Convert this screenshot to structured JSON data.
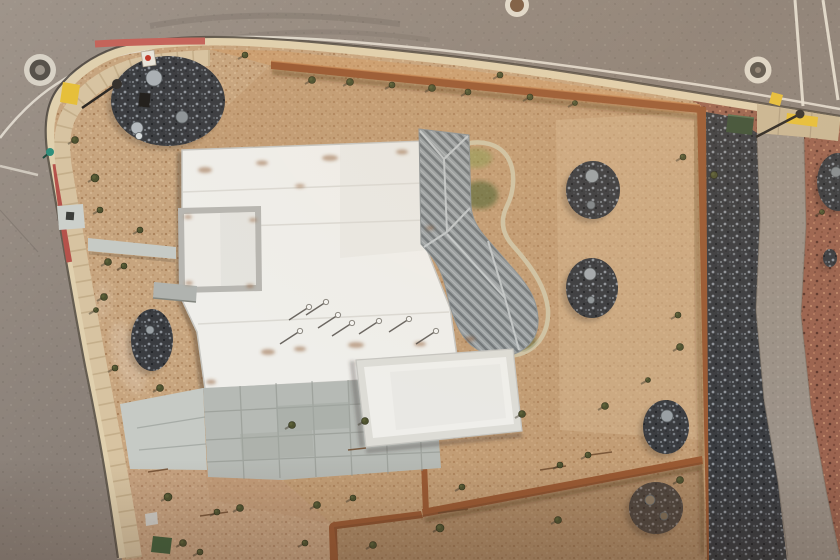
{
  "colors": {
    "asphalt": "#8a8078",
    "road_line_white": "#e9e3d7",
    "curb_tan": "#e0d0ae",
    "curb_red_corner": "#c4635a",
    "curb_red_left": "#b5524b",
    "sidewalk_tan": "#d7c3a1",
    "gravel_tan": "#c7a57f",
    "gravel_inner_tint": "#b98f63",
    "gravel_band_orange": "#d19a62",
    "red_mulch": "#9b6450",
    "rock_dark": "#3a3c40",
    "corten_wall": "#9a5a33",
    "corten_highlight": "#c98a55",
    "lawn_green": "#3f6d26",
    "lawn_edge": "#cfc3a4",
    "roof_white": "#efeeea",
    "roof_metal_gray": "#9ba1a3",
    "concrete": "#b6bab5",
    "concrete_light": "#c6cac5",
    "path_gray": "#9c9288",
    "apron_tan": "#c9b795",
    "safety_yellow": "#e6bf3a",
    "utility_green": "#3d5138",
    "hydrant_teal": "#2f8f7c",
    "rust_stain": "#8e5a33",
    "shrub_olive": "#4e5230",
    "shrub_shadow": "#3a3526",
    "boulder_gray": "#a6acb0"
  },
  "scene": {
    "shrubs": [
      [
        75,
        140,
        3.5
      ],
      [
        95,
        178,
        4
      ],
      [
        108,
        262,
        3.5
      ],
      [
        140,
        230,
        3
      ],
      [
        104,
        297,
        3.5
      ],
      [
        124,
        266,
        3
      ],
      [
        100,
        210,
        3
      ],
      [
        96,
        310,
        2.5
      ],
      [
        115,
        368,
        3
      ],
      [
        245,
        55,
        3
      ],
      [
        312,
        80,
        3.5
      ],
      [
        350,
        82,
        3.5
      ],
      [
        392,
        85,
        3
      ],
      [
        432,
        88,
        3.5
      ],
      [
        468,
        92,
        3
      ],
      [
        500,
        75,
        3
      ],
      [
        530,
        97,
        3
      ],
      [
        575,
        103,
        2.5
      ],
      [
        683,
        157,
        3
      ],
      [
        714,
        175,
        3.5
      ],
      [
        678,
        315,
        3
      ],
      [
        680,
        347,
        3.5
      ],
      [
        822,
        212,
        2.5
      ],
      [
        160,
        388,
        3.5
      ],
      [
        168,
        497,
        4
      ],
      [
        183,
        543,
        3.5
      ],
      [
        200,
        552,
        3
      ],
      [
        217,
        512,
        3
      ],
      [
        240,
        508,
        3.5
      ],
      [
        292,
        425,
        3.5
      ],
      [
        305,
        543,
        3
      ],
      [
        317,
        505,
        3.5
      ],
      [
        353,
        498,
        3
      ],
      [
        373,
        545,
        3.5
      ],
      [
        365,
        421,
        3.5
      ],
      [
        440,
        528,
        4
      ],
      [
        462,
        487,
        3
      ],
      [
        522,
        414,
        3.5
      ],
      [
        558,
        520,
        3.5
      ],
      [
        560,
        465,
        3
      ],
      [
        588,
        455,
        3
      ],
      [
        605,
        406,
        3.5
      ],
      [
        680,
        480,
        3.5
      ],
      [
        648,
        380,
        2.5
      ]
    ],
    "roof_vents": [
      [
        309,
        307
      ],
      [
        326,
        302
      ],
      [
        338,
        315
      ],
      [
        352,
        323
      ],
      [
        379,
        321
      ],
      [
        409,
        319
      ],
      [
        436,
        331
      ],
      [
        300,
        331
      ]
    ],
    "rust_stains": [
      [
        205,
        170,
        7,
        3
      ],
      [
        262,
        163,
        6,
        2.5
      ],
      [
        330,
        158,
        8,
        3
      ],
      [
        402,
        152,
        6,
        2.5
      ],
      [
        300,
        186,
        5,
        2
      ],
      [
        268,
        352,
        7,
        3
      ],
      [
        300,
        349,
        6,
        2.5
      ],
      [
        356,
        345,
        8,
        3
      ],
      [
        420,
        344,
        6,
        2.5
      ],
      [
        470,
        339,
        5,
        2.5
      ],
      [
        211,
        382,
        5,
        2.5
      ],
      [
        188,
        217,
        4,
        2
      ],
      [
        253,
        220,
        4,
        2
      ],
      [
        189,
        283,
        4,
        2
      ],
      [
        250,
        286,
        4,
        2
      ],
      [
        362,
        442,
        6,
        3
      ],
      [
        516,
        425,
        5,
        2.5
      ],
      [
        360,
        363,
        4,
        2
      ],
      [
        460,
        430,
        4,
        2
      ],
      [
        510,
        355,
        4,
        2
      ],
      [
        430,
        228,
        4,
        2
      ]
    ],
    "rock_beds": [
      [
        168,
        101,
        57,
        45
      ],
      [
        593,
        190,
        27,
        29
      ],
      [
        592,
        288,
        26,
        30
      ],
      [
        152,
        340,
        21,
        31
      ],
      [
        666,
        427,
        23,
        27
      ],
      [
        656,
        508,
        27,
        26,
        "#7a5a3c"
      ],
      [
        838,
        182,
        21,
        29
      ],
      [
        830,
        258,
        7,
        9
      ]
    ],
    "boulders": [
      [
        154,
        78,
        8,
        "#aab0b4"
      ],
      [
        182,
        117,
        6,
        "#8e9498"
      ],
      [
        137,
        128,
        6,
        "#b4babe"
      ],
      [
        139,
        136,
        3.5,
        "#d8dcdd"
      ],
      [
        592,
        176,
        6.5,
        "#9aa1a5"
      ],
      [
        591,
        205,
        4,
        "#7e858a"
      ],
      [
        590,
        274,
        6,
        "#a3a9ad"
      ],
      [
        591,
        300,
        3.5,
        "#8f969a"
      ],
      [
        667,
        416,
        6,
        "#99a0a4"
      ],
      [
        650,
        500,
        5,
        "#8b7a64"
      ],
      [
        664,
        516,
        4,
        "#7d6c56"
      ],
      [
        150,
        330,
        4,
        "#9aa0a4"
      ],
      [
        836,
        172,
        5,
        "#868c90"
      ]
    ],
    "sticks": [
      [
        200,
        516,
        228,
        512
      ],
      [
        438,
        513,
        468,
        509
      ],
      [
        540,
        470,
        566,
        466
      ],
      [
        148,
        472,
        168,
        469
      ],
      [
        590,
        455,
        612,
        452
      ],
      [
        348,
        450,
        366,
        448
      ]
    ]
  }
}
